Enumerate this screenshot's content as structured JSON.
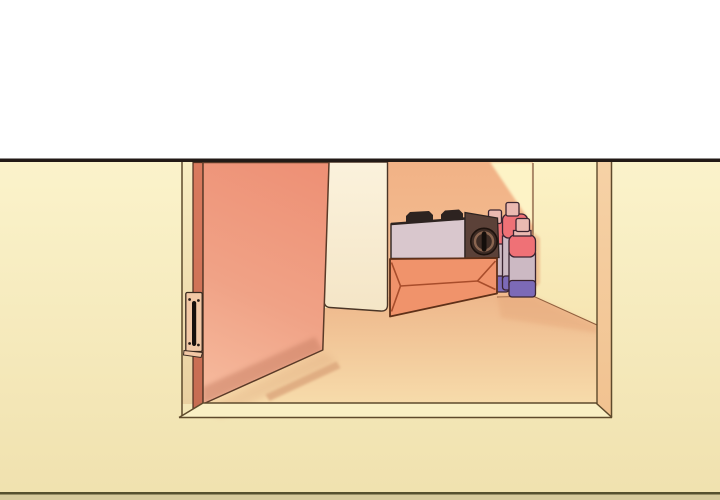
{
  "scene": {
    "type": "webtoon-comic-panel",
    "description": "An open salmon-colored door reveals a closet nook containing a portable gas stove resting on a cardboard box, with three butane gas canisters standing beside it on the floor.",
    "objects": [
      "top white gutter",
      "panel border line",
      "room wall",
      "open door",
      "door edge",
      "door hinge",
      "light interior panel",
      "closet back wall",
      "closet side wall",
      "door frame jamb",
      "threshold sill",
      "floor",
      "door shadow on floor",
      "portable gas stove",
      "stove pan supports",
      "stove control knob",
      "cardboard box",
      "butane canister left",
      "butane canister middle",
      "butane canister right",
      "bottom border line"
    ]
  },
  "colors": {
    "white": "#ffffff",
    "panel_line": "#221a16",
    "wall_top": "#fbf3cb",
    "wall_bottom": "#f0e1ae",
    "inner_jamb_top": "#f8edc2",
    "inner_jamb_bottom": "#e9d0a0",
    "door_top": "#ee9176",
    "door_mid": "#f0a286",
    "door_bottom_light": "#f6bb9e",
    "door_edge": "#d97a5e",
    "door_edge_dark": "#c66c52",
    "door_shade": "#c67f63",
    "hinge_plate": "#f2c8a6",
    "hinge_pin": "#17100c",
    "panel_top": "#fbf2dc",
    "panel_bottom": "#f4e5c6",
    "back_wall_top": "#f1b286",
    "back_wall_bottom": "#f5c094",
    "lit_wall": "#fdf3c6",
    "right_wall_top": "#fcf2c5",
    "right_wall_bottom": "#f6e5b2",
    "jamb_top": "#f6d2a6",
    "jamb_bottom": "#f1c290",
    "floor_back": "#eeb78b",
    "floor_front": "#f7dcab",
    "floor_shadow": "#dda87e",
    "floor_shadow_right": "#e6a97c",
    "corner_shadow": "#e7a476",
    "sill": "#f9efc4",
    "frame_line": "#5e4a2c",
    "wall_base_line": "#7d4e30",
    "box_front": "#f0936b",
    "box_crease": "#a84d2b",
    "box_outline": "#5f3018",
    "stove_body": "#d9c7cd",
    "stove_panel": "#5b4138",
    "stove_dark": "#2d2320",
    "knob": "#3e2c25",
    "knob_ring": "#8a6550",
    "knob_slot": "#140e0b",
    "can_cap": "#eab9b1",
    "can_red": "#ef7176",
    "can_body": "#ccb9c3",
    "can_purple": "#7c6ab7",
    "can_outline": "#3a2430",
    "bottom_line": "#55502e",
    "bottom_strip": "#d6ca9c"
  }
}
